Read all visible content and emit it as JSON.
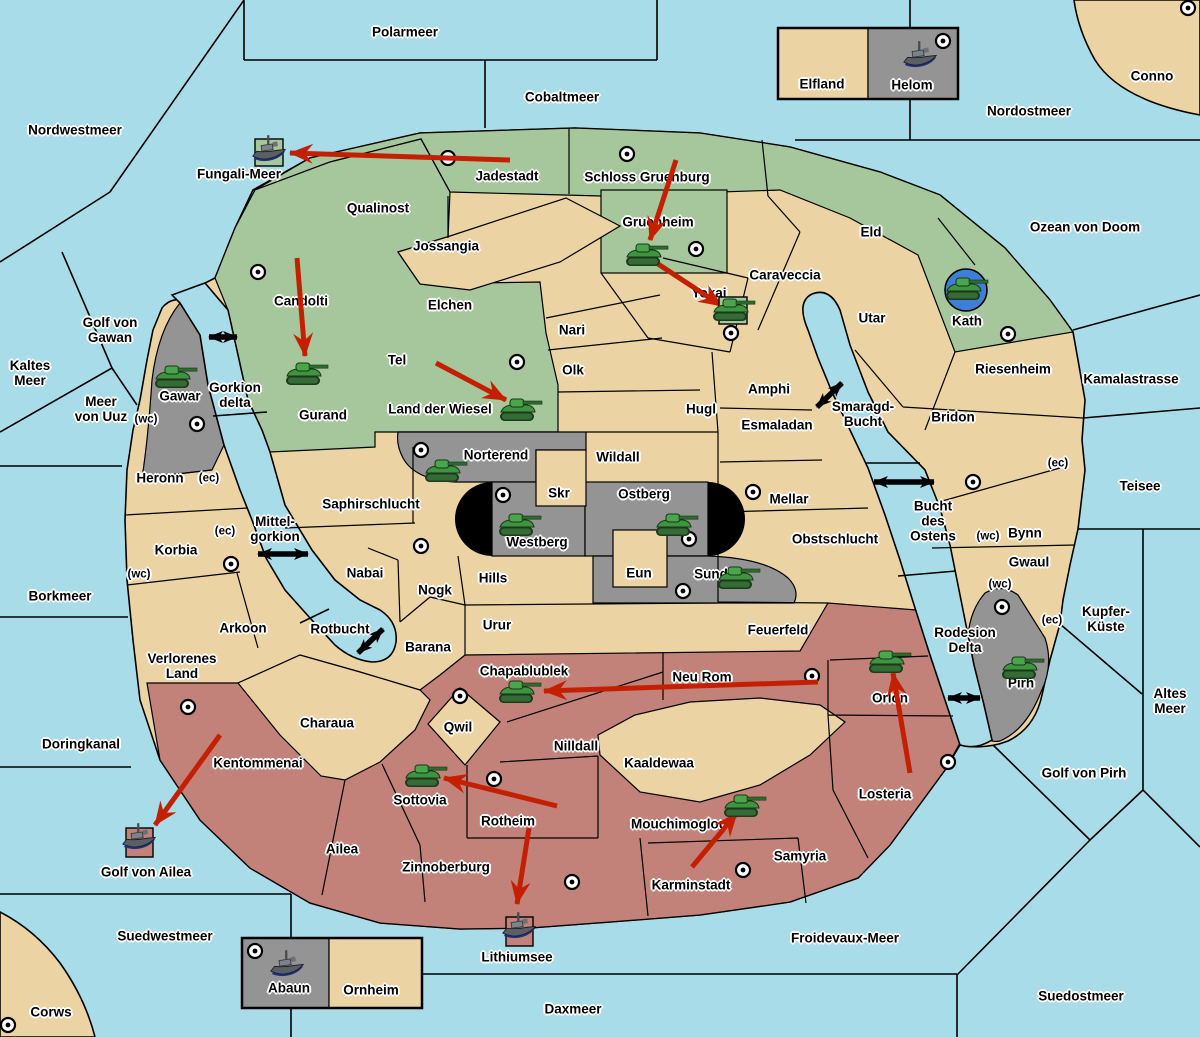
{
  "map": {
    "colors": {
      "sea": "#A8DCE8",
      "land": "#EBD3A3",
      "green_power": "#A5C79B",
      "gray_power": "#949494",
      "red_power": "#C28179",
      "move_arrow": "#C42000",
      "strait_arrow": "#000000",
      "tank": "#3F9440",
      "ship": "#5A5F66",
      "kath_circle": "#3D7FD6"
    },
    "sea_labels": [
      {
        "t": "Polarmeer",
        "x": 405,
        "y": 33
      },
      {
        "t": "Nordwestmeer",
        "x": 75,
        "y": 131
      },
      {
        "t": "Cobaltmeer",
        "x": 562,
        "y": 98
      },
      {
        "t": "Nordostmeer",
        "x": 1029,
        "y": 112
      },
      {
        "t": "Ozean von Doom",
        "x": 1085,
        "y": 228
      },
      {
        "t": "Fungali-Meer",
        "x": 239,
        "y": 175
      },
      {
        "t": "Kamalastrasse",
        "x": 1131,
        "y": 380
      },
      {
        "t": "Teisee",
        "x": 1140,
        "y": 487
      },
      {
        "t": "Kaltes\nMeer",
        "x": 30,
        "y": 374
      },
      {
        "t": "Golf von\nGawan",
        "x": 110,
        "y": 331
      },
      {
        "t": "Meer\nvon Uuz",
        "x": 101,
        "y": 410
      },
      {
        "t": "Borkmeer",
        "x": 60,
        "y": 597
      },
      {
        "t": "Doringkanal",
        "x": 81,
        "y": 745
      },
      {
        "t": "Golf von Ailea",
        "x": 146,
        "y": 873
      },
      {
        "t": "Suedwestmeer",
        "x": 165,
        "y": 937
      },
      {
        "t": "Daxmeer",
        "x": 573,
        "y": 1010
      },
      {
        "t": "Lithiumsee",
        "x": 517,
        "y": 958
      },
      {
        "t": "Froidevaux-Meer",
        "x": 845,
        "y": 939
      },
      {
        "t": "Suedostmeer",
        "x": 1081,
        "y": 997
      },
      {
        "t": "Altes\nMeer",
        "x": 1170,
        "y": 702
      },
      {
        "t": "Golf von Pirh",
        "x": 1084,
        "y": 774
      },
      {
        "t": "Kupfer-\nKüste",
        "x": 1106,
        "y": 620
      },
      {
        "t": "Smaragd-\nBucht",
        "x": 863,
        "y": 415
      },
      {
        "t": "Bucht\ndes\nOstens",
        "x": 933,
        "y": 522
      },
      {
        "t": "Rodesion\nDelta",
        "x": 965,
        "y": 641
      },
      {
        "t": "Gorkion\ndelta",
        "x": 235,
        "y": 396
      },
      {
        "t": "Mittel-\ngorkion",
        "x": 275,
        "y": 530
      },
      {
        "t": "Rotbucht",
        "x": 340,
        "y": 630
      }
    ],
    "territory_labels": [
      {
        "t": "Qualinost",
        "x": 378,
        "y": 209
      },
      {
        "t": "Jadestadt",
        "x": 507,
        "y": 177
      },
      {
        "t": "Schloss Gruenburg",
        "x": 647,
        "y": 178
      },
      {
        "t": "Gruenheim",
        "x": 658,
        "y": 223
      },
      {
        "t": "Caraveccia",
        "x": 785,
        "y": 276
      },
      {
        "t": "Eld",
        "x": 871,
        "y": 233
      },
      {
        "t": "Kath",
        "x": 967,
        "y": 322
      },
      {
        "t": "Candolti",
        "x": 301,
        "y": 302
      },
      {
        "t": "Jossangia",
        "x": 446,
        "y": 247
      },
      {
        "t": "Elchen",
        "x": 450,
        "y": 306
      },
      {
        "t": "Nari",
        "x": 572,
        "y": 331
      },
      {
        "t": "Olk",
        "x": 573,
        "y": 371
      },
      {
        "t": "Tel",
        "x": 397,
        "y": 361
      },
      {
        "t": "Land der Wiesel",
        "x": 440,
        "y": 410
      },
      {
        "t": "Gurand",
        "x": 323,
        "y": 416
      },
      {
        "t": "Yokai",
        "x": 709,
        "y": 294
      },
      {
        "t": "Utar",
        "x": 872,
        "y": 319
      },
      {
        "t": "Riesenheim",
        "x": 1013,
        "y": 370
      },
      {
        "t": "Bridon",
        "x": 953,
        "y": 418
      },
      {
        "t": "Bynn",
        "x": 1025,
        "y": 534
      },
      {
        "t": "Gwaul",
        "x": 1029,
        "y": 563
      },
      {
        "t": "Pirh",
        "x": 1021,
        "y": 684
      },
      {
        "t": "Hugl",
        "x": 701,
        "y": 410
      },
      {
        "t": "Amphi",
        "x": 769,
        "y": 390
      },
      {
        "t": "Esmaladan",
        "x": 777,
        "y": 426
      },
      {
        "t": "Wildall",
        "x": 618,
        "y": 458
      },
      {
        "t": "Mellar",
        "x": 789,
        "y": 500
      },
      {
        "t": "Obstschlucht",
        "x": 835,
        "y": 540
      },
      {
        "t": "Feuerfeld",
        "x": 778,
        "y": 631
      },
      {
        "t": "Skr",
        "x": 559,
        "y": 494
      },
      {
        "t": "Ostberg",
        "x": 644,
        "y": 495
      },
      {
        "t": "Westberg",
        "x": 537,
        "y": 543
      },
      {
        "t": "Eun",
        "x": 639,
        "y": 574
      },
      {
        "t": "Sund",
        "x": 711,
        "y": 575
      },
      {
        "t": "Norterend",
        "x": 496,
        "y": 456
      },
      {
        "t": "Saphirschlucht",
        "x": 371,
        "y": 505
      },
      {
        "t": "Heronn",
        "x": 160,
        "y": 479
      },
      {
        "t": "Korbia",
        "x": 176,
        "y": 551
      },
      {
        "t": "Nabai",
        "x": 365,
        "y": 574
      },
      {
        "t": "Nogk",
        "x": 435,
        "y": 591
      },
      {
        "t": "Hills",
        "x": 493,
        "y": 579
      },
      {
        "t": "Urur",
        "x": 497,
        "y": 626
      },
      {
        "t": "Barana",
        "x": 428,
        "y": 648
      },
      {
        "t": "Verlorenes\nLand",
        "x": 182,
        "y": 667
      },
      {
        "t": "Arkoon",
        "x": 243,
        "y": 629
      },
      {
        "t": "Charaua",
        "x": 327,
        "y": 724
      },
      {
        "t": "Kentommenai",
        "x": 258,
        "y": 764
      },
      {
        "t": "Ailea",
        "x": 342,
        "y": 850
      },
      {
        "t": "Qwil",
        "x": 458,
        "y": 728
      },
      {
        "t": "Chapablublek",
        "x": 524,
        "y": 672
      },
      {
        "t": "Nilldall",
        "x": 576,
        "y": 747
      },
      {
        "t": "Neu Rom",
        "x": 702,
        "y": 678
      },
      {
        "t": "Kaaldewaa",
        "x": 659,
        "y": 764
      },
      {
        "t": "Sottovia",
        "x": 420,
        "y": 801
      },
      {
        "t": "Rotheim",
        "x": 508,
        "y": 822
      },
      {
        "t": "Mouchimoglou",
        "x": 679,
        "y": 825
      },
      {
        "t": "Zinnoberburg",
        "x": 446,
        "y": 868
      },
      {
        "t": "Karminstadt",
        "x": 691,
        "y": 886
      },
      {
        "t": "Samyria",
        "x": 800,
        "y": 857
      },
      {
        "t": "Losteria",
        "x": 885,
        "y": 795
      },
      {
        "t": "Orlon",
        "x": 890,
        "y": 699
      },
      {
        "t": "Gawar",
        "x": 180,
        "y": 397
      },
      {
        "t": "Abaun",
        "x": 289,
        "y": 989
      },
      {
        "t": "Ornheim",
        "x": 371,
        "y": 991
      },
      {
        "t": "Elfland",
        "x": 822,
        "y": 85
      },
      {
        "t": "Helom",
        "x": 912,
        "y": 86
      },
      {
        "t": "Conno",
        "x": 1152,
        "y": 77
      },
      {
        "t": "Corws",
        "x": 51,
        "y": 1013
      }
    ],
    "coast_labels": [
      {
        "t": "(wc)",
        "x": 146,
        "y": 420
      },
      {
        "t": "(ec)",
        "x": 209,
        "y": 479
      },
      {
        "t": "(ec)",
        "x": 225,
        "y": 532
      },
      {
        "t": "(wc)",
        "x": 139,
        "y": 575
      },
      {
        "t": "(ec)",
        "x": 1058,
        "y": 464
      },
      {
        "t": "(wc)",
        "x": 988,
        "y": 537
      },
      {
        "t": "(wc)",
        "x": 1000,
        "y": 585
      },
      {
        "t": "(ec)",
        "x": 1052,
        "y": 621
      }
    ],
    "supply_centers": [
      [
        448,
        158
      ],
      [
        627,
        154
      ],
      [
        696,
        249
      ],
      [
        943,
        41
      ],
      [
        1188,
        8
      ],
      [
        258,
        272
      ],
      [
        1008,
        334
      ],
      [
        731,
        333
      ],
      [
        197,
        424
      ],
      [
        517,
        362
      ],
      [
        421,
        450
      ],
      [
        503,
        495
      ],
      [
        753,
        492
      ],
      [
        689,
        539
      ],
      [
        683,
        591
      ],
      [
        421,
        546
      ],
      [
        231,
        564
      ],
      [
        973,
        482
      ],
      [
        1002,
        607
      ],
      [
        188,
        707
      ],
      [
        460,
        696
      ],
      [
        494,
        779
      ],
      [
        812,
        676
      ],
      [
        572,
        882
      ],
      [
        743,
        870
      ],
      [
        948,
        762
      ],
      [
        255,
        951
      ],
      [
        8,
        1025
      ]
    ],
    "units": [
      {
        "t": "tank",
        "x": 306,
        "y": 374,
        "loc": "Gurand"
      },
      {
        "t": "tank",
        "x": 646,
        "y": 255,
        "loc": "Gruenheim"
      },
      {
        "t": "tank",
        "x": 733,
        "y": 310,
        "loc": "Yokai",
        "platform": "green-box"
      },
      {
        "t": "tank",
        "x": 520,
        "y": 410,
        "loc": "Land der Wiesel"
      },
      {
        "t": "tank",
        "x": 175,
        "y": 377,
        "loc": "Gawar"
      },
      {
        "t": "tank",
        "x": 445,
        "y": 471,
        "loc": "Norterend"
      },
      {
        "t": "tank",
        "x": 519,
        "y": 525,
        "loc": "Westberg"
      },
      {
        "t": "tank",
        "x": 676,
        "y": 525,
        "loc": "Ostberg"
      },
      {
        "t": "tank",
        "x": 738,
        "y": 578,
        "loc": "Sund"
      },
      {
        "t": "tank",
        "x": 966,
        "y": 289,
        "loc": "Kath",
        "platform": "blue-circle"
      },
      {
        "t": "tank",
        "x": 519,
        "y": 692,
        "loc": "Chapablublek"
      },
      {
        "t": "tank",
        "x": 425,
        "y": 776,
        "loc": "Sottovia"
      },
      {
        "t": "tank",
        "x": 744,
        "y": 806,
        "loc": "Mouchimoglou"
      },
      {
        "t": "tank",
        "x": 889,
        "y": 662,
        "loc": "Orlon"
      },
      {
        "t": "tank",
        "x": 1022,
        "y": 668,
        "loc": "Pirh"
      },
      {
        "t": "ship",
        "x": 269,
        "y": 152,
        "loc": "Fungali-Meer",
        "platform": "green-box"
      },
      {
        "t": "ship",
        "x": 920,
        "y": 58,
        "loc": "Helom"
      },
      {
        "t": "ship",
        "x": 139,
        "y": 840,
        "loc": "Golf von Ailea",
        "platform": "red-box"
      },
      {
        "t": "ship",
        "x": 519,
        "y": 929,
        "loc": "Lithiumsee",
        "platform": "red-box"
      },
      {
        "t": "ship",
        "x": 287,
        "y": 967,
        "loc": "Abaun"
      }
    ],
    "move_arrows": [
      [
        510,
        160,
        290,
        153
      ],
      [
        297,
        258,
        305,
        356
      ],
      [
        436,
        363,
        506,
        400
      ],
      [
        676,
        160,
        650,
        240
      ],
      [
        655,
        262,
        722,
        306
      ],
      [
        557,
        806,
        444,
        778
      ],
      [
        818,
        682,
        544,
        691
      ],
      [
        692,
        867,
        737,
        813
      ],
      [
        910,
        773,
        893,
        673
      ],
      [
        220,
        735,
        155,
        825
      ],
      [
        529,
        828,
        517,
        904
      ]
    ],
    "strait_arrows": [
      [
        209,
        337,
        237,
        337
      ],
      [
        258,
        554,
        308,
        554
      ],
      [
        817,
        407,
        842,
        383
      ],
      [
        874,
        482,
        934,
        482
      ],
      [
        358,
        653,
        383,
        629
      ],
      [
        948,
        698,
        980,
        698
      ]
    ]
  }
}
